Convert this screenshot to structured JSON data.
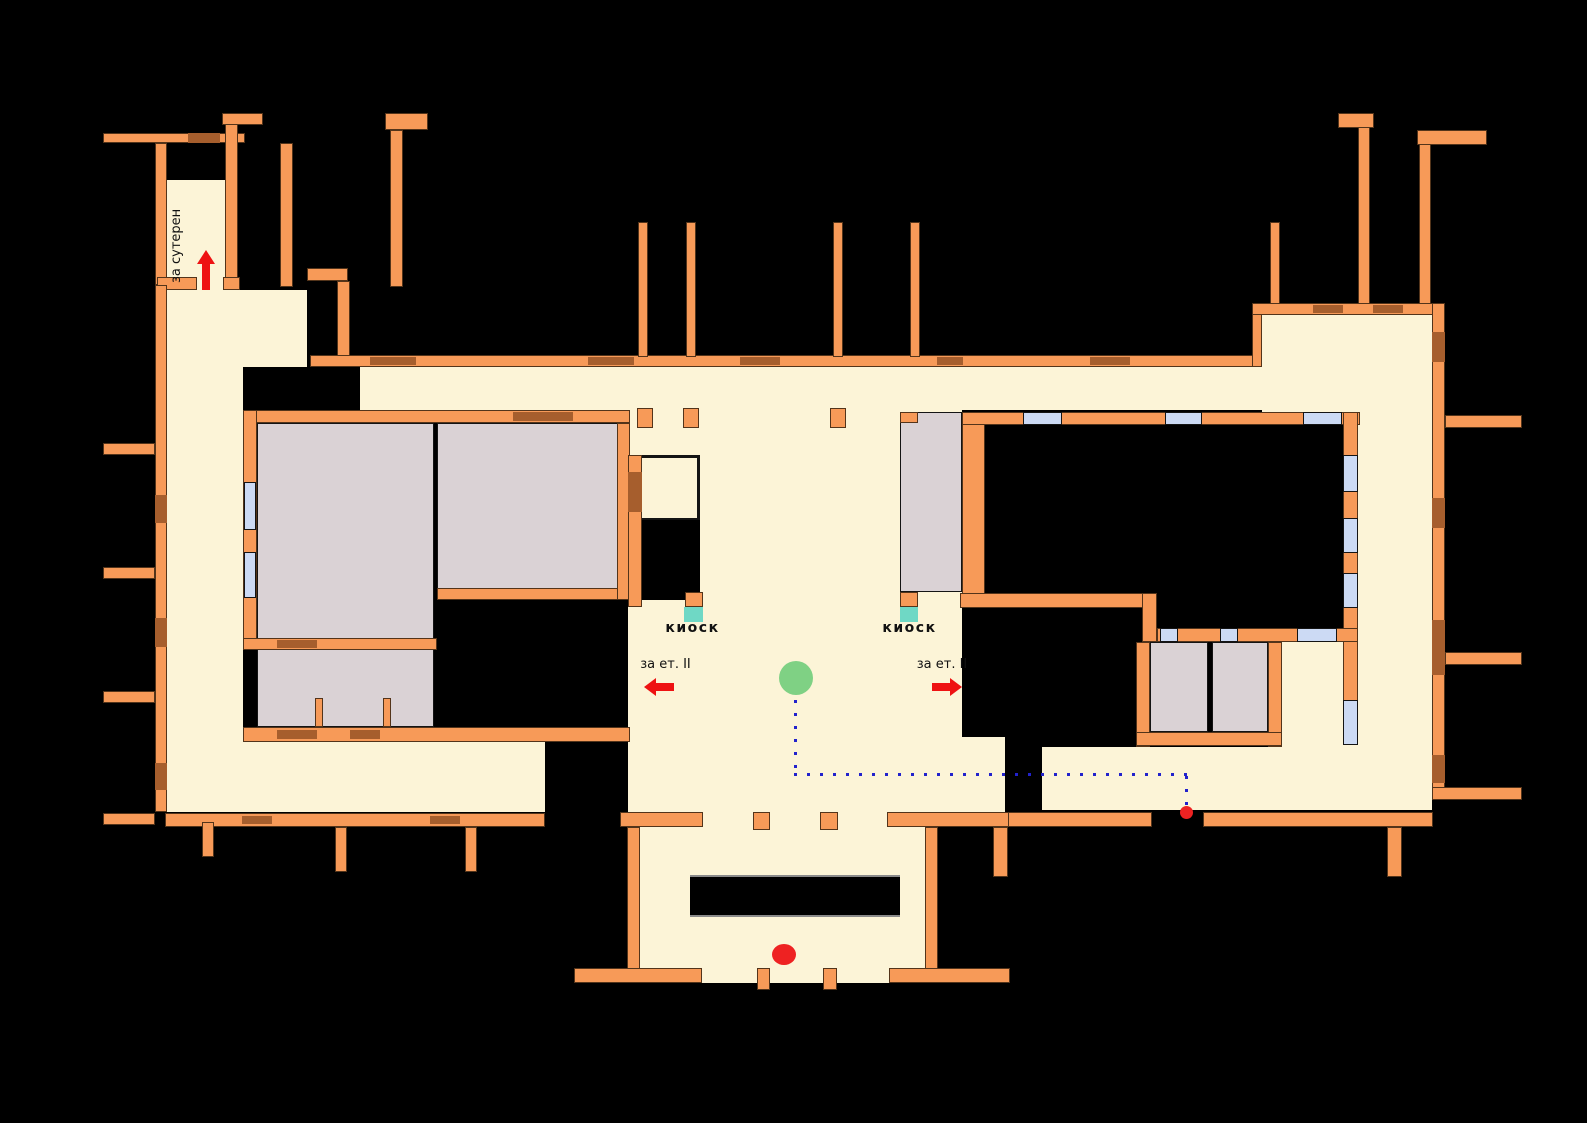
{
  "plan": {
    "labels": {
      "to_basement": "за сутерен",
      "kiosk_left": "киоск",
      "kiosk_right": "киоск",
      "to_floor2_left": "за ет. II",
      "to_floor2_right": "за ет. II"
    },
    "icons": {
      "arrow_up_icon": "red block arrow pointing up (to basement)",
      "arrow_left_icon": "red block arrow pointing left (to floor II)",
      "arrow_right_icon": "red block arrow pointing right (to floor II)",
      "start_marker": "green circle",
      "entrance_marker": "red circle",
      "route_end_marker": "small red dot",
      "route_path": "blue dotted route line",
      "kiosk_marker": "teal square"
    },
    "colors": {
      "background": "#000000",
      "wall_orange": "#F79A58",
      "wall_outline": "#53341A",
      "door_brown": "#A65E2D",
      "floor_cream": "#FCF4D7",
      "room_gray": "#DAD2D5",
      "window_blue": "#CCDAF4",
      "kiosk_teal": "#6FD8C5",
      "marker_green": "#7FD184",
      "marker_red": "#EE2222",
      "route_blue": "#2222CC"
    }
  }
}
